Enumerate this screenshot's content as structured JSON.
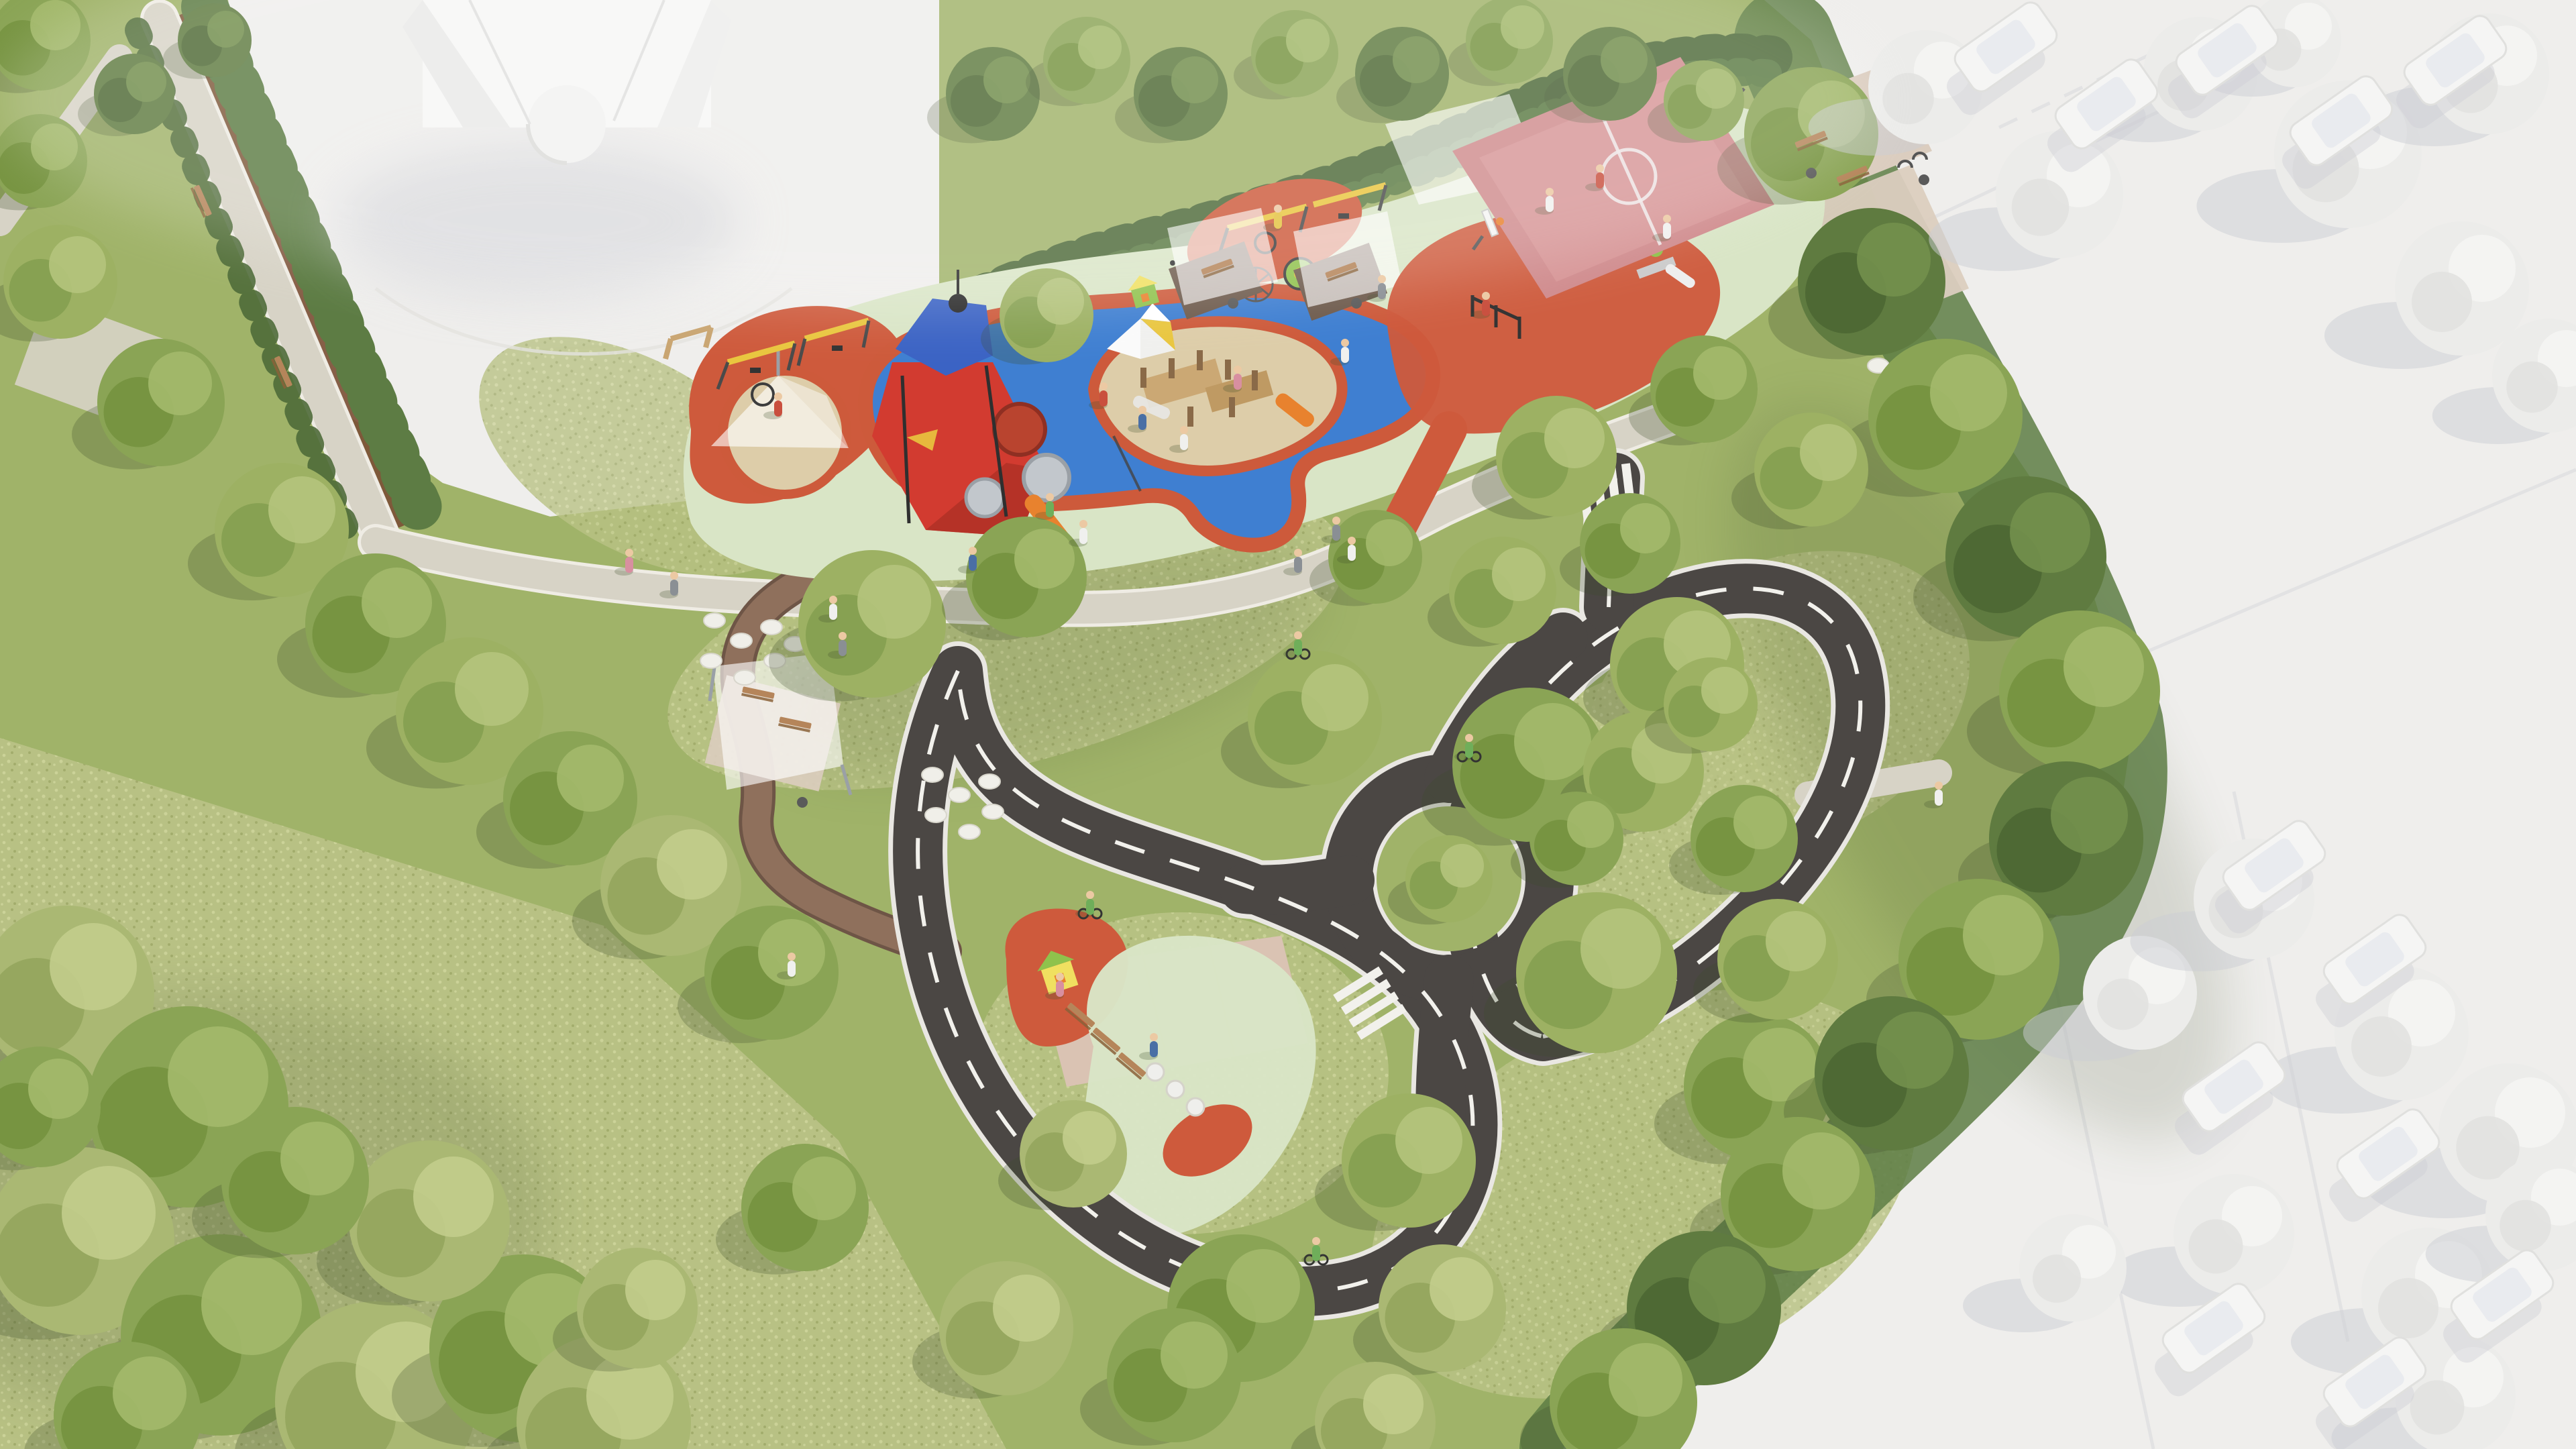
{
  "meta": {
    "title": "Aerial render of a neighborhood playground park",
    "description": "Bird's-eye 3D architectural rendering of a park: a long playground band with red play tower, tube slides, sand pits, blue and red rubber safety surfacing, shade sails, swings, carousel and a pink basketball court; a children's traffic-training garden with mini asphalt roads, dashed lane markings, zebra crossings and a roundabout; wild meadow lawns with large trees; surrounding context (streets, cars, buildings, trees) rendered in untextured white clay style."
  },
  "palette": {
    "clay_white": "#efeeec",
    "clay_shadow": "#ccced4",
    "lawn": "#a0b369",
    "meadow_base": "#b9c285",
    "meadow_light": "#cdd49b",
    "meadow_dark": "#a2ac6c",
    "shade_green": "#3f4f2a",
    "gravel": "#d7d3c6",
    "gravel_edge": "#efece4",
    "paver_brown": "#8f705c",
    "paver_brown_edge": "#6e5546",
    "paver_pink": "#dac3b3",
    "paver_warm": "#dbcdbf",
    "asphalt": "#4b4744",
    "road_edge": "#e9e7e2",
    "road_line": "#f2f1ec",
    "rubber_blue": "#3f7fd1",
    "rubber_red": "#ce5a3c",
    "rubber_mint": "#d9e5c6",
    "sand": "#ddcda9",
    "court_pink": "#d08c8e",
    "court_light": "#dd9f9e",
    "court_line": "#f0e9e9",
    "tower_red": "#d23b30",
    "tower_red_dark": "#a82f23",
    "tower_blue": "#3b63c4",
    "slide_orange": "#e8822e",
    "swing_yellow": "#e9c63f",
    "play_green": "#8fc24c",
    "play_yellow": "#f0e060",
    "wood": "#c9a571",
    "wood_dark": "#8a6a48",
    "bench_wood": "#b5855a",
    "bench_wood_dark": "#8a6238",
    "sail_white": "#ffffff",
    "hedge_dark": "#4e6a39",
    "hedge_mid": "#5d7c44",
    "mulch": "#7b5036",
    "white_tree": "#ececea",
    "white_tree_hi": "#f4f4f2",
    "car_white": "#f5f5f4",
    "skin": "#ecc9a3",
    "metal_dark": "#3d3d3d",
    "tree_variants": [
      [
        "#9db163",
        "#85a050",
        "#b5c47c"
      ],
      [
        "#8aa455",
        "#74923f",
        "#a3b96b"
      ],
      [
        "#5f7b40",
        "#4c6733",
        "#73904d"
      ],
      [
        "#ececea",
        "#e2e2e0",
        "#f6f6f4"
      ],
      [
        "#aab873",
        "#93a55d",
        "#c2cd8c"
      ]
    ],
    "people_colors": {
      "red": "#c94f3e",
      "blue": "#4a6fa5",
      "white": "#f0f0ee",
      "pink": "#d88fa0",
      "gray": "#8a8f94",
      "green": "#6fae5a",
      "yellow": "#e3c23f"
    }
  },
  "scene": {
    "inventory": {
      "playground": [
        "shade sails",
        "red play tower with tube slides",
        "orange slide",
        "sand pits",
        "timber climbing structure",
        "conical canopy over sand",
        "swing frames",
        "nest swing",
        "carousel",
        "climbing-net cone",
        "green playhouse",
        "percussion posts",
        "calisthenics posts",
        "picnic nooks with benches",
        "basketball court with two hoops",
        "fitness corner under sails"
      ],
      "traffic_garden": [
        "mini asphalt roads with dashed centerlines",
        "zebra crossings",
        "roundabout with tree island",
        "paver practice plaza",
        "balance beams",
        "white seat pots",
        "red rubber pad with playhouse",
        "mint rubber pad",
        "children on bicycles"
      ],
      "park": [
        "gravel boulevard with hedges and benches",
        "brown paver promenade",
        "stepping-stone circles",
        "shade pavilion with picnic tables",
        "wild meadow",
        "large trees"
      ],
      "context_white_model": [
        "church-like building",
        "streets",
        "parked cars",
        "low-poly trees"
      ]
    },
    "trees": [
      [
        100,
        1480,
        130,
        4
      ],
      [
        280,
        1650,
        150,
        1
      ],
      [
        120,
        1850,
        140,
        4
      ],
      [
        330,
        1990,
        150,
        1
      ],
      [
        560,
        2090,
        150,
        4
      ],
      [
        780,
        2010,
        140,
        1
      ],
      [
        640,
        1820,
        120,
        4
      ],
      [
        900,
        2120,
        130,
        4
      ],
      [
        440,
        1760,
        110,
        1
      ],
      [
        190,
        2110,
        110,
        1
      ],
      [
        950,
        1950,
        90,
        4
      ],
      [
        60,
        1650,
        90,
        1
      ],
      [
        90,
        420,
        85,
        0
      ],
      [
        240,
        600,
        95,
        1
      ],
      [
        420,
        790,
        100,
        0
      ],
      [
        560,
        930,
        105,
        1
      ],
      [
        700,
        1060,
        110,
        0
      ],
      [
        850,
        1190,
        100,
        1
      ],
      [
        1000,
        1320,
        105,
        4
      ],
      [
        1150,
        1450,
        100,
        1
      ],
      [
        60,
        240,
        70,
        1
      ],
      [
        200,
        140,
        60,
        2
      ],
      [
        60,
        60,
        75,
        1
      ],
      [
        320,
        60,
        55,
        2
      ],
      [
        1300,
        930,
        110,
        0
      ],
      [
        1530,
        860,
        90,
        1
      ],
      [
        1960,
        1070,
        100,
        0
      ],
      [
        2280,
        1140,
        115,
        1
      ],
      [
        2500,
        990,
        100,
        0
      ],
      [
        2380,
        1450,
        120,
        0
      ],
      [
        2620,
        1620,
        110,
        1
      ],
      [
        2100,
        1730,
        100,
        0
      ],
      [
        1850,
        1950,
        110,
        1
      ],
      [
        2150,
        1950,
        95,
        4
      ],
      [
        1500,
        1980,
        100,
        4
      ],
      [
        1200,
        1800,
        95,
        1
      ],
      [
        1600,
        1720,
        80,
        4
      ],
      [
        2450,
        1150,
        90,
        0
      ],
      [
        2600,
        1250,
        80,
        1
      ],
      [
        2350,
        1250,
        70,
        1
      ],
      [
        2550,
        1050,
        70,
        0
      ],
      [
        2160,
        1310,
        65,
        0
      ],
      [
        2700,
        200,
        100,
        1
      ],
      [
        2790,
        420,
        110,
        2
      ],
      [
        2900,
        620,
        115,
        1
      ],
      [
        3020,
        830,
        120,
        2
      ],
      [
        3100,
        1030,
        120,
        1
      ],
      [
        3080,
        1250,
        115,
        2
      ],
      [
        2950,
        1430,
        120,
        1
      ],
      [
        2820,
        1600,
        115,
        2
      ],
      [
        2680,
        1780,
        115,
        1
      ],
      [
        2540,
        1950,
        115,
        2
      ],
      [
        2420,
        2090,
        110,
        1
      ],
      [
        2650,
        1430,
        90,
        0
      ],
      [
        1560,
        470,
        70,
        0
      ],
      [
        2320,
        680,
        90,
        0
      ],
      [
        2540,
        580,
        80,
        1
      ],
      [
        2700,
        700,
        85,
        0
      ],
      [
        2430,
        810,
        75,
        1
      ],
      [
        2240,
        880,
        80,
        0
      ],
      [
        2050,
        830,
        70,
        1
      ],
      [
        1480,
        140,
        70,
        2
      ],
      [
        1620,
        90,
        65,
        1
      ],
      [
        1760,
        140,
        70,
        2
      ],
      [
        1930,
        80,
        65,
        1
      ],
      [
        2090,
        110,
        70,
        2
      ],
      [
        2250,
        60,
        65,
        1
      ],
      [
        2400,
        110,
        70,
        2
      ],
      [
        2540,
        150,
        60,
        1
      ],
      [
        1750,
        2050,
        100,
        1
      ],
      [
        2050,
        2120,
        90,
        4
      ]
    ],
    "white_trees": [
      [
        2870,
        130,
        85
      ],
      [
        3070,
        290,
        95
      ],
      [
        3280,
        110,
        85
      ],
      [
        3500,
        230,
        110
      ],
      [
        3710,
        110,
        90
      ],
      [
        3670,
        430,
        100
      ],
      [
        3800,
        560,
        85
      ],
      [
        3420,
        60,
        70
      ],
      [
        3190,
        1480,
        85
      ],
      [
        3360,
        1340,
        90
      ],
      [
        3580,
        1540,
        100
      ],
      [
        3740,
        1690,
        105
      ],
      [
        3330,
        1840,
        90
      ],
      [
        3620,
        1930,
        100
      ],
      [
        3790,
        1810,
        85
      ],
      [
        3090,
        1890,
        80
      ],
      [
        3660,
        2080,
        90
      ]
    ],
    "cars": [
      [
        2990,
        70,
        -35
      ],
      [
        3140,
        155,
        -35
      ],
      [
        3320,
        75,
        -35
      ],
      [
        3490,
        180,
        -35
      ],
      [
        3660,
        90,
        -35
      ],
      [
        3390,
        1290,
        -35
      ],
      [
        3540,
        1430,
        -35
      ],
      [
        3330,
        1620,
        -35
      ],
      [
        3560,
        1720,
        -35
      ],
      [
        3300,
        1980,
        -35
      ],
      [
        3540,
        2060,
        -35
      ],
      [
        3730,
        1930,
        -35
      ]
    ],
    "people": [
      [
        1645,
        590,
        "red"
      ],
      [
        1703,
        625,
        "blue"
      ],
      [
        1765,
        655,
        "white"
      ],
      [
        1565,
        755,
        "green"
      ],
      [
        1615,
        795,
        "white"
      ],
      [
        1845,
        565,
        "pink"
      ],
      [
        2005,
        525,
        "white"
      ],
      [
        2215,
        455,
        "red"
      ],
      [
        2485,
        340,
        "white"
      ],
      [
        1450,
        835,
        "blue"
      ],
      [
        1935,
        838,
        "gray"
      ],
      [
        1992,
        790,
        "gray"
      ],
      [
        2015,
        820,
        "white"
      ],
      [
        1242,
        908,
        "white"
      ],
      [
        1256,
        962,
        "gray"
      ],
      [
        938,
        838,
        "pink"
      ],
      [
        1005,
        872,
        "gray"
      ],
      [
        1180,
        1440,
        "white"
      ],
      [
        2890,
        1185,
        "white"
      ],
      [
        2385,
        265,
        "red"
      ],
      [
        2310,
        300,
        "white"
      ],
      [
        1905,
        325,
        "yellow"
      ],
      [
        1160,
        605,
        "red"
      ],
      [
        1580,
        1470,
        "pink"
      ],
      [
        1720,
        1560,
        "blue"
      ],
      [
        2060,
        430,
        "gray"
      ]
    ],
    "cyclists": [
      [
        1935,
        965
      ],
      [
        2190,
        1118
      ],
      [
        1962,
        1868
      ],
      [
        1625,
        1352
      ]
    ],
    "stepping_stones": [
      [
        1065,
        925
      ],
      [
        1105,
        955
      ],
      [
        1060,
        985
      ],
      [
        1110,
        1010
      ],
      [
        1155,
        985
      ],
      [
        1150,
        935
      ],
      [
        1185,
        960
      ],
      [
        1390,
        1155
      ],
      [
        1430,
        1185
      ],
      [
        1395,
        1215
      ],
      [
        1445,
        1240
      ],
      [
        1480,
        1210
      ],
      [
        1475,
        1165
      ],
      [
        2800,
        545
      ],
      [
        2840,
        575
      ],
      [
        2805,
        605
      ],
      [
        2850,
        635
      ],
      [
        2890,
        600
      ],
      [
        2885,
        560
      ],
      [
        2920,
        630
      ]
    ],
    "benches": [
      [
        300,
        300,
        66
      ],
      [
        420,
        555,
        66
      ],
      [
        1130,
        1035,
        12
      ],
      [
        1185,
        1080,
        12
      ],
      [
        1815,
        400,
        -20
      ],
      [
        2000,
        405,
        -20
      ],
      [
        2700,
        210,
        -22
      ],
      [
        2762,
        262,
        -22
      ],
      [
        1610,
        1515,
        40
      ],
      [
        1648,
        1552,
        40
      ],
      [
        1686,
        1589,
        40
      ]
    ],
    "bins": [
      [
        1838,
        452
      ],
      [
        2022,
        452
      ],
      [
        2700,
        258
      ],
      [
        1196,
        1196
      ],
      [
        2868,
        268
      ]
    ]
  }
}
